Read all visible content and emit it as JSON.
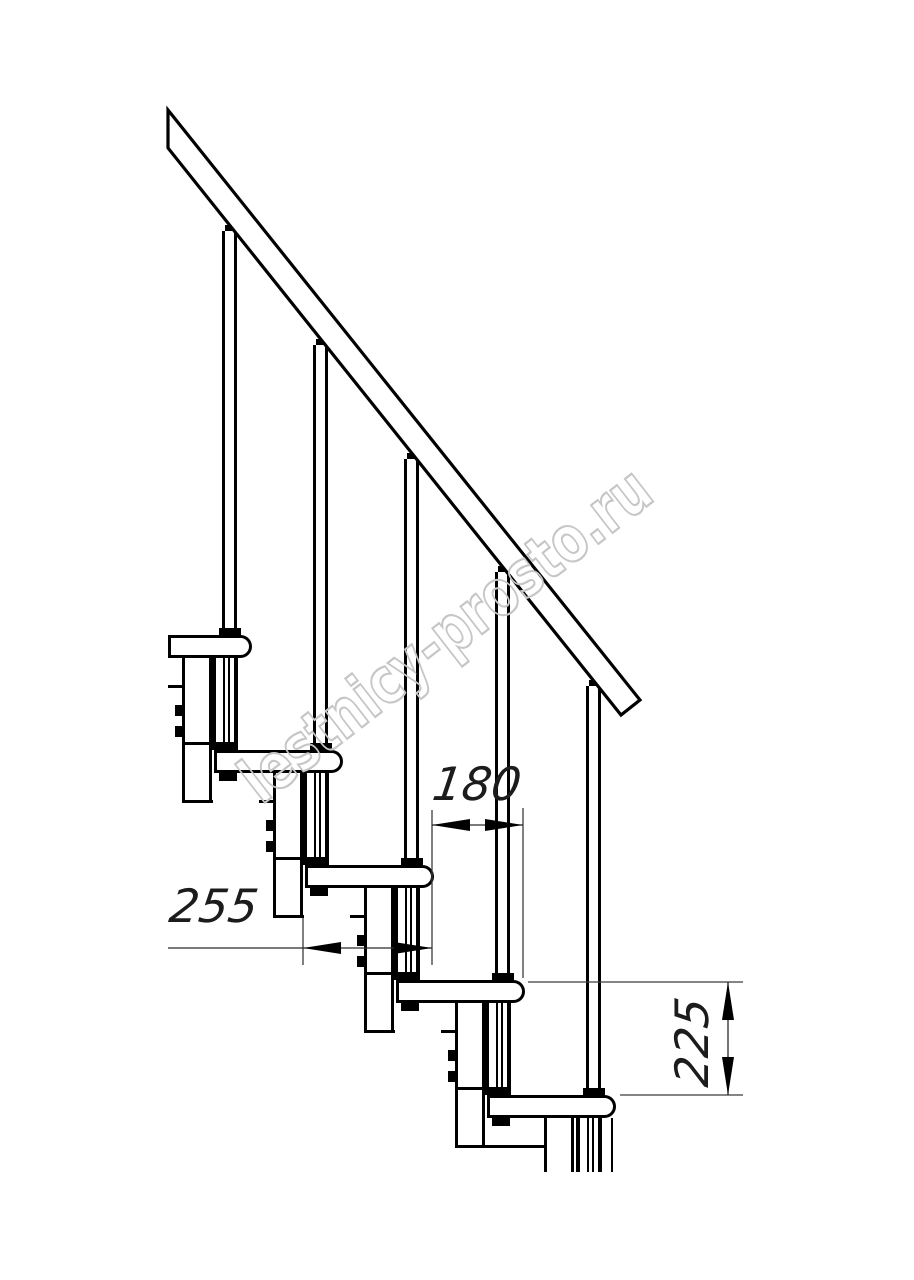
{
  "drawing": {
    "title": "Modular staircase side-view drawing",
    "watermark": {
      "text": "lestnicy-prosto.ru",
      "color": "#c6c6c6"
    },
    "line_color": "#000000",
    "background_color": "#ffffff",
    "dimensions": {
      "run": {
        "label": "180",
        "value": 180
      },
      "tread_depth": {
        "label": "255",
        "value": 255
      },
      "rise": {
        "label": "225",
        "value": 225
      }
    },
    "components": {
      "handrail_count": 1,
      "tread_count": 5,
      "baluster_count": 5,
      "module_count": 5
    }
  }
}
